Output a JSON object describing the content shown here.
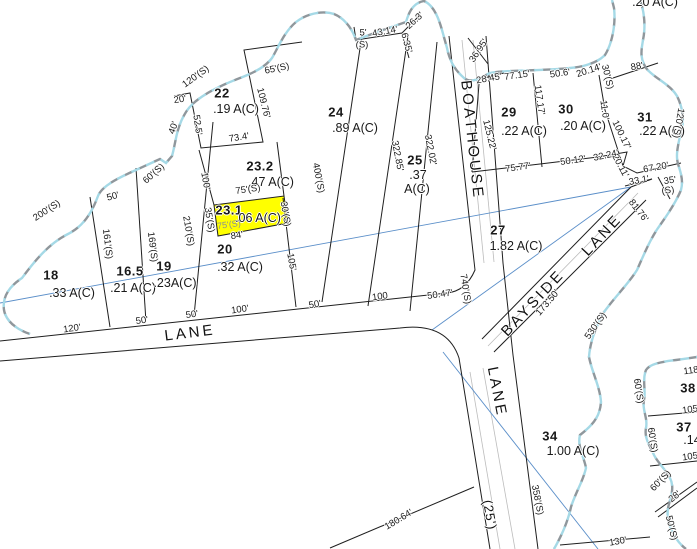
{
  "map": {
    "highlight_color": "#ffff00",
    "highlighted_parcel": {
      "id": "23.1",
      "acreage": ".06 A(C)"
    },
    "colors": {
      "line": "#1f1f1f",
      "water_gray": "#8f979c",
      "water_cyan": "#a5d9e6",
      "tie_line": "#5b8fc9",
      "road_inner": "#bcbcbc"
    },
    "parcel_labels": [
      {
        "t": "18",
        "x": 51,
        "y": 275,
        "cls": "pid"
      },
      {
        "t": ".33 A(C)",
        "x": 72,
        "y": 293,
        "cls": "pac"
      },
      {
        "t": "16.5",
        "x": 130,
        "y": 271,
        "cls": "pid"
      },
      {
        "t": ".21 A(C)",
        "x": 133,
        "y": 288,
        "cls": "pac"
      },
      {
        "t": "19",
        "x": 164,
        "y": 266,
        "cls": "pid"
      },
      {
        "t": ".23A(C)",
        "x": 175,
        "y": 283,
        "cls": "pac"
      },
      {
        "t": "20",
        "x": 225,
        "y": 249,
        "cls": "pid"
      },
      {
        "t": ".32 A(C)",
        "x": 240,
        "y": 267,
        "cls": "pac"
      },
      {
        "t": "22",
        "x": 222,
        "y": 93,
        "cls": "pid"
      },
      {
        "t": ".19 A(C)",
        "x": 236,
        "y": 109,
        "cls": "pac"
      },
      {
        "t": "23.2",
        "x": 260,
        "y": 166,
        "cls": "pid"
      },
      {
        "t": ".47 A(C)",
        "x": 271,
        "y": 182,
        "cls": "pac"
      },
      {
        "t": "23.1",
        "x": 229,
        "y": 210,
        "cls": "pid"
      },
      {
        "t": ".06 A(C)",
        "x": 258,
        "y": 218,
        "cls": "pac"
      },
      {
        "t": "24",
        "x": 336,
        "y": 112,
        "cls": "pid"
      },
      {
        "t": ".89 A(C)",
        "x": 355,
        "y": 128,
        "cls": "pac"
      },
      {
        "t": "25",
        "x": 415,
        "y": 160,
        "cls": "pid"
      },
      {
        "t": ".37",
        "x": 418,
        "y": 175,
        "cls": "pac"
      },
      {
        "t": "A(C)",
        "x": 417,
        "y": 189,
        "cls": "pac"
      },
      {
        "t": "27",
        "x": 498,
        "y": 230,
        "cls": "pid"
      },
      {
        "t": "1.82 A(C)",
        "x": 516,
        "y": 246,
        "cls": "pac"
      },
      {
        "t": "29",
        "x": 509,
        "y": 112,
        "cls": "pid"
      },
      {
        "t": ".22 A(C)",
        "x": 524,
        "y": 131,
        "cls": "pac"
      },
      {
        "t": "30",
        "x": 566,
        "y": 109,
        "cls": "pid"
      },
      {
        "t": ".20 A(C)",
        "x": 583,
        "y": 126,
        "cls": "pac"
      },
      {
        "t": "31",
        "x": 645,
        "y": 117,
        "cls": "pid"
      },
      {
        "t": ".22 A(C)",
        "x": 662,
        "y": 131,
        "cls": "pac"
      },
      {
        "t": "34",
        "x": 550,
        "y": 436,
        "cls": "pid"
      },
      {
        "t": "1.00 A(C)",
        "x": 573,
        "y": 451,
        "cls": "pac"
      },
      {
        "t": "38",
        "x": 688,
        "y": 388,
        "cls": "pid"
      },
      {
        "t": "37",
        "x": 684,
        "y": 427,
        "cls": "pid"
      },
      {
        "t": ".14",
        "x": 692,
        "y": 440,
        "cls": "pac"
      },
      {
        "t": ".20 A(C)",
        "x": 655,
        "y": 2,
        "cls": "pac"
      }
    ],
    "road_labels": [
      {
        "t": "LANE",
        "x": 190,
        "y": 333,
        "r": -7,
        "cls": "road"
      },
      {
        "t": "BOATHOUSE",
        "x": 472,
        "y": 140,
        "r": 84,
        "cls": "road"
      },
      {
        "t": "BAYSIDE",
        "x": 533,
        "y": 303,
        "r": -47,
        "cls": "road"
      },
      {
        "t": "LANE",
        "x": 602,
        "y": 235,
        "r": -47,
        "cls": "road"
      },
      {
        "t": "LANE",
        "x": 497,
        "y": 392,
        "r": 79,
        "cls": "road"
      },
      {
        "t": "(25')",
        "x": 490,
        "y": 515,
        "r": 80,
        "cls": "road-sm"
      }
    ],
    "dimension_labels": [
      {
        "t": "200'(S)",
        "x": 47,
        "y": 211,
        "r": -33
      },
      {
        "t": "50'",
        "x": 113,
        "y": 197,
        "r": -15
      },
      {
        "t": "60'(S)",
        "x": 154,
        "y": 174,
        "r": -42
      },
      {
        "t": "161'(S)",
        "x": 107,
        "y": 244,
        "r": 83
      },
      {
        "t": "169'(S)",
        "x": 152,
        "y": 247,
        "r": 83
      },
      {
        "t": "210'(S)",
        "x": 188,
        "y": 231,
        "r": 80
      },
      {
        "t": "120'(S)",
        "x": 196,
        "y": 77,
        "r": -36
      },
      {
        "t": "20'",
        "x": 180,
        "y": 100,
        "r": -8
      },
      {
        "t": "40'",
        "x": 174,
        "y": 128,
        "r": -70
      },
      {
        "t": "52.5'",
        "x": 197,
        "y": 125,
        "r": 82
      },
      {
        "t": "73.4'",
        "x": 239,
        "y": 138,
        "r": -9
      },
      {
        "t": "109.76'",
        "x": 263,
        "y": 103,
        "r": 76
      },
      {
        "t": "65'(S)",
        "x": 277,
        "y": 69,
        "r": -12
      },
      {
        "t": "100'",
        "x": 205,
        "y": 181,
        "r": 80
      },
      {
        "t": "75'(S)",
        "x": 248,
        "y": 190,
        "r": -8
      },
      {
        "t": "35'(S)",
        "x": 209,
        "y": 220,
        "r": 80
      },
      {
        "t": "75'(S)",
        "x": 229,
        "y": 225,
        "r": -8,
        "cls": "dim-gray"
      },
      {
        "t": "30'(S)",
        "x": 285,
        "y": 214,
        "r": 80
      },
      {
        "t": "84'",
        "x": 237,
        "y": 236,
        "r": -8
      },
      {
        "t": "105'",
        "x": 291,
        "y": 262,
        "r": 80
      },
      {
        "t": "400'(S)",
        "x": 318,
        "y": 178,
        "r": 79
      },
      {
        "t": "5'",
        "x": 363,
        "y": 33,
        "r": 0
      },
      {
        "t": "(S)",
        "x": 362,
        "y": 45,
        "r": 0
      },
      {
        "t": "43.14'",
        "x": 385,
        "y": 32,
        "r": -10
      },
      {
        "t": "6.35'",
        "x": 406,
        "y": 43,
        "r": 75
      },
      {
        "t": "26.3'",
        "x": 415,
        "y": 21,
        "r": -42
      },
      {
        "t": "322.85'",
        "x": 397,
        "y": 156,
        "r": 79
      },
      {
        "t": "322.02'",
        "x": 430,
        "y": 150,
        "r": 79
      },
      {
        "t": "36.95'",
        "x": 479,
        "y": 51,
        "r": -56
      },
      {
        "t": "28.45'",
        "x": 489,
        "y": 79,
        "r": -10
      },
      {
        "t": "77.15'",
        "x": 517,
        "y": 76,
        "r": -8
      },
      {
        "t": "50.6'",
        "x": 560,
        "y": 74,
        "r": -8
      },
      {
        "t": "20.14'",
        "x": 589,
        "y": 71,
        "r": -18
      },
      {
        "t": "30'(S)",
        "x": 607,
        "y": 77,
        "r": 76
      },
      {
        "t": "88'",
        "x": 637,
        "y": 67,
        "r": -10
      },
      {
        "t": "117.17'",
        "x": 539,
        "y": 100,
        "r": 82
      },
      {
        "t": "11.0'",
        "x": 604,
        "y": 110,
        "r": 82
      },
      {
        "t": "100.17'",
        "x": 621,
        "y": 135,
        "r": 64
      },
      {
        "t": "125.22'",
        "x": 489,
        "y": 135,
        "r": 76
      },
      {
        "t": "120'(S)",
        "x": 678,
        "y": 123,
        "r": 100
      },
      {
        "t": "75.77'",
        "x": 518,
        "y": 168,
        "r": -8
      },
      {
        "t": "50.12'",
        "x": 573,
        "y": 161,
        "r": -8
      },
      {
        "t": "32.24'",
        "x": 606,
        "y": 156,
        "r": -12
      },
      {
        "t": "20.11'",
        "x": 620,
        "y": 166,
        "r": 62
      },
      {
        "t": "67.20'",
        "x": 656,
        "y": 168,
        "r": -10
      },
      {
        "t": "33.1'",
        "x": 639,
        "y": 181,
        "r": -10
      },
      {
        "t": "35'",
        "x": 670,
        "y": 181,
        "r": -8
      },
      {
        "t": "(S)",
        "x": 668,
        "y": 191,
        "r": -8
      },
      {
        "t": "81.76'",
        "x": 638,
        "y": 211,
        "r": 52
      },
      {
        "t": "173.50'",
        "x": 548,
        "y": 303,
        "r": -49
      },
      {
        "t": "530'(S)",
        "x": 596,
        "y": 326,
        "r": -55
      },
      {
        "t": "740'(S)",
        "x": 465,
        "y": 289,
        "r": 81
      },
      {
        "t": "120'",
        "x": 72,
        "y": 329,
        "r": -8
      },
      {
        "t": "50'",
        "x": 142,
        "y": 321,
        "r": -8
      },
      {
        "t": "50'",
        "x": 192,
        "y": 315,
        "r": -8
      },
      {
        "t": "100'",
        "x": 240,
        "y": 310,
        "r": -8
      },
      {
        "t": "50'",
        "x": 315,
        "y": 305,
        "r": -10
      },
      {
        "t": "100",
        "x": 380,
        "y": 297,
        "r": -8
      },
      {
        "t": "50.47'",
        "x": 440,
        "y": 295,
        "r": -8
      },
      {
        "t": "180.64'",
        "x": 399,
        "y": 520,
        "r": -31
      },
      {
        "t": "358'(S)",
        "x": 537,
        "y": 500,
        "r": 79
      },
      {
        "t": "130'",
        "x": 618,
        "y": 542,
        "r": -10
      },
      {
        "t": "28'",
        "x": 675,
        "y": 497,
        "r": -38
      },
      {
        "t": "60'(S)",
        "x": 638,
        "y": 391,
        "r": 81
      },
      {
        "t": "60'(S)",
        "x": 652,
        "y": 440,
        "r": 81
      },
      {
        "t": "60'(S)",
        "x": 661,
        "y": 481,
        "r": -46
      },
      {
        "t": "50'(S)",
        "x": 671,
        "y": 528,
        "r": 76
      },
      {
        "t": "118'",
        "x": 692,
        "y": 371,
        "r": -8
      },
      {
        "t": "105'",
        "x": 691,
        "y": 410,
        "r": -8
      },
      {
        "t": "105'",
        "x": 691,
        "y": 457,
        "r": -8
      }
    ]
  }
}
